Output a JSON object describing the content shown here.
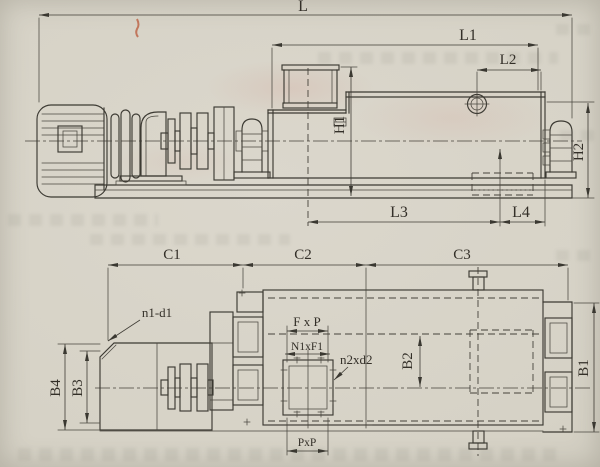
{
  "drawing": {
    "kind": "engineering outline drawing, two orthographic views of a screw conveyor with drive unit",
    "colors": {
      "paper": "#d6d2c6",
      "ink": "#3c3a33",
      "red_mark": "#b8502f"
    },
    "views": {
      "side_elevation": {
        "dimension_labels": [
          "L",
          "L1",
          "L2",
          "H1",
          "H2",
          "L3",
          "L4"
        ]
      },
      "plan": {
        "dimension_labels": [
          "C1",
          "C2",
          "C3",
          "B4",
          "B3",
          "B2",
          "B1",
          "n1-d1",
          "F x P",
          "N1xF1",
          "n2xd2",
          "PxP"
        ]
      }
    },
    "labels": {
      "L": "L",
      "L1": "L1",
      "L2": "L2",
      "L3": "L3",
      "L4": "L4",
      "H1": "H1",
      "H2": "H2",
      "C1": "C1",
      "C2": "C2",
      "C3": "C3",
      "B1": "B1",
      "B2": "B2",
      "B3": "B3",
      "B4": "B4",
      "n1d1": "n1-d1",
      "fxp": "F x P",
      "n1xf1": "N1xF1",
      "n2xd2": "n2xd2",
      "pxp": "PxP"
    }
  }
}
